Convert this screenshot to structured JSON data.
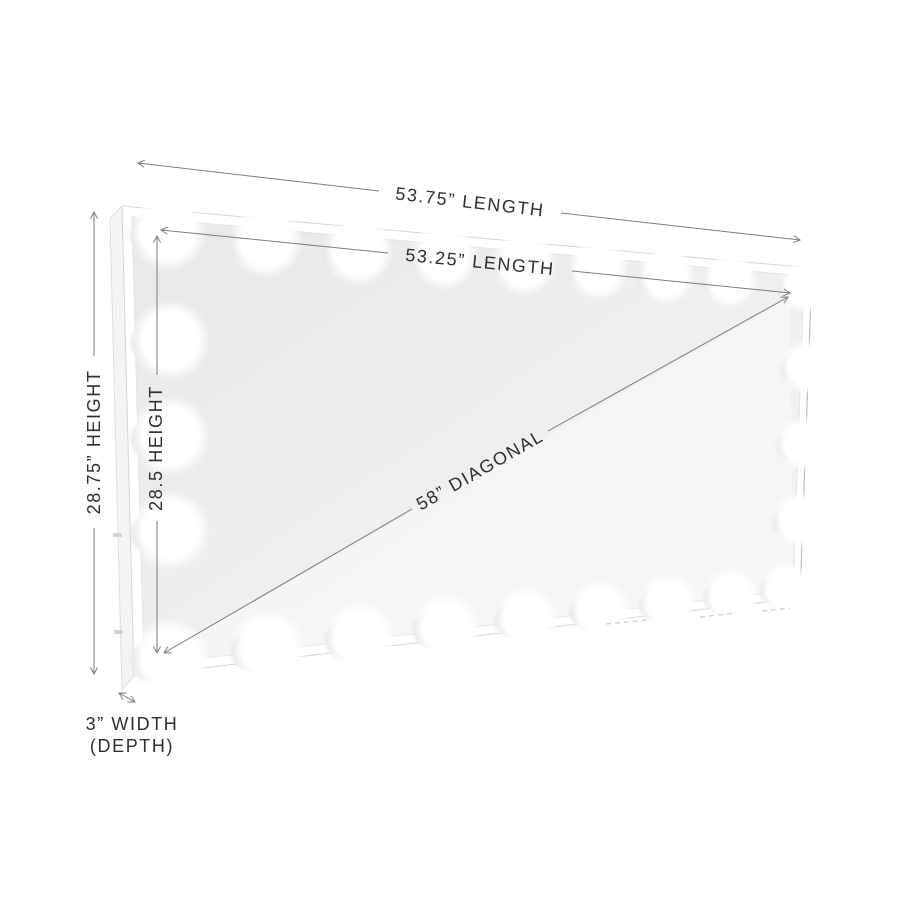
{
  "page": {
    "background_color": "#ffffff"
  },
  "diagram": {
    "kind": "product-dimension-diagram",
    "subject": "lighted-vanity-mirror",
    "bulb_count": 24,
    "labels": {
      "outer_length": "53.75” LENGTH",
      "inner_length": "53.25” LENGTH",
      "outer_height": "28.75” HEIGHT",
      "inner_height": "28.5 HEIGHT",
      "diagonal": "58” DIAGONAL",
      "depth_line_1": "3” WIDTH",
      "depth_line_2": "(DEPTH)"
    },
    "values": {
      "outer_length_in": 53.75,
      "inner_length_in": 53.25,
      "outer_height_in": 28.75,
      "inner_height_in": 28.5,
      "diagonal_in": 58,
      "depth_in": 3
    },
    "colors": {
      "dimension_line": "#7b7b7b",
      "label_text": "#2e2e2e",
      "glass": "#ededed",
      "frame": "#ffffff",
      "bulb": "#ffffff",
      "socket": "#e1e1e1"
    }
  }
}
